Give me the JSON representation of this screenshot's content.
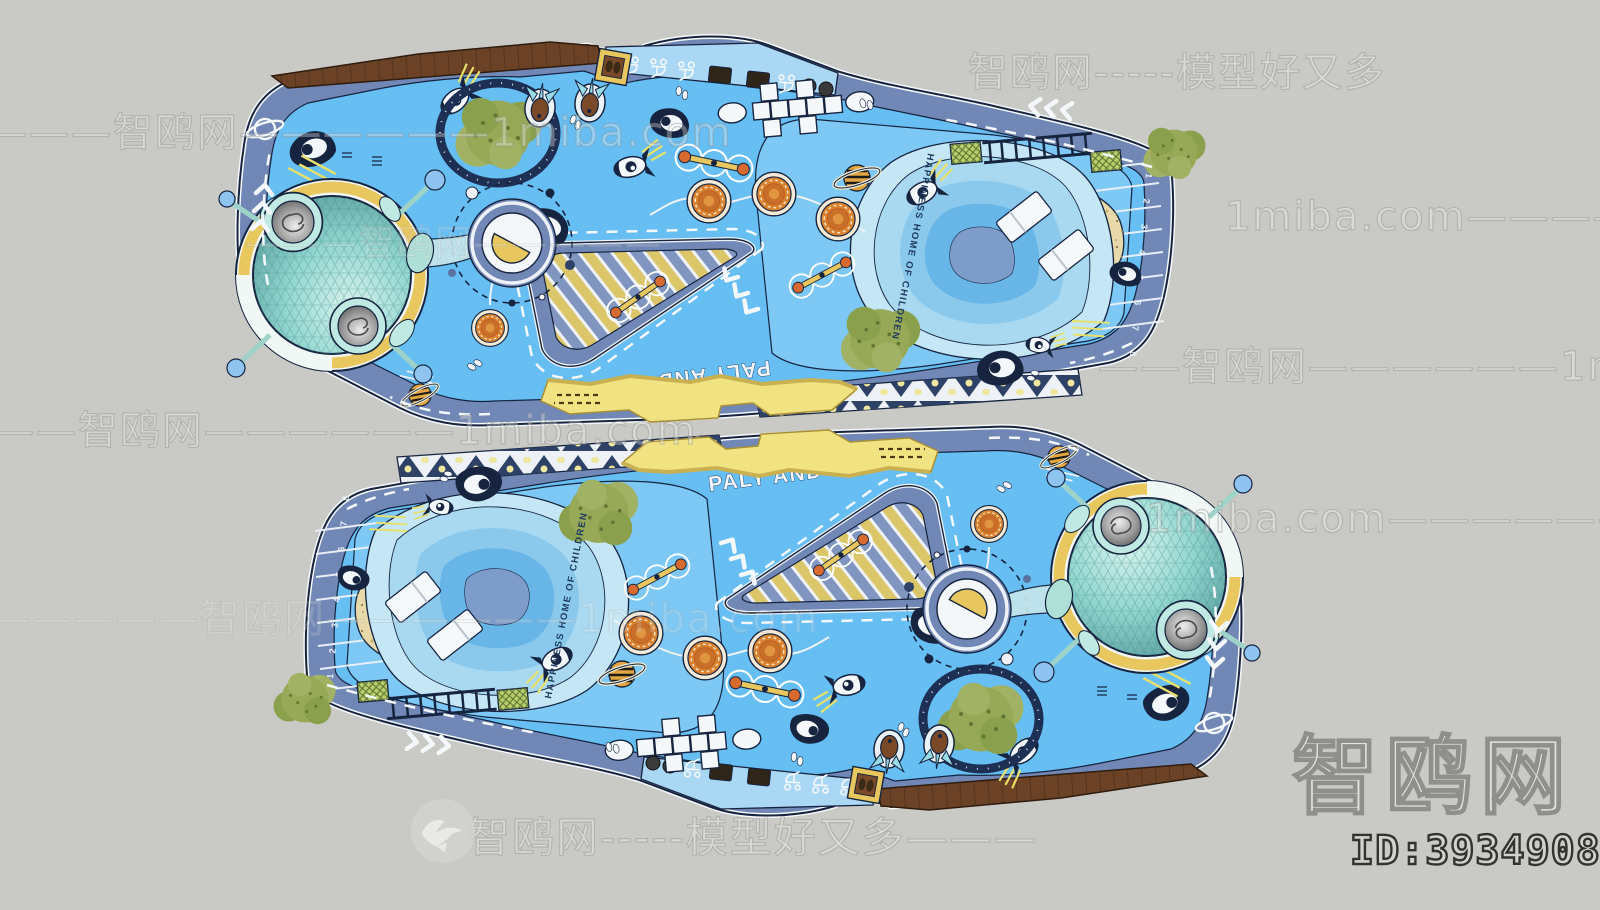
{
  "image": {
    "type": "3d-model-top-view-preview",
    "subject": "space themed children playground (two copies, one rotated 180°)",
    "background": "#c9c9c5"
  },
  "model": {
    "sign_text": "PALY AND STUDY",
    "slogan_text": "HAPPINESS HOME OF CHILDREN",
    "parking_numbers": "1 2 3 4 5 6 7 8",
    "colors": {
      "ground": "#66bef3",
      "pool_zone": "#7dc8f4",
      "path_band": "#7187b5",
      "outline": "#16243f",
      "pool": [
        "#c4e6f5",
        "#a9d9f1",
        "#8bc9ec",
        "#68b5e7",
        "#7e9cc9"
      ],
      "sand": "#e8d9ab",
      "sphere_shell": "#93d6d0",
      "sphere_base": "#f0f7f5",
      "accent_yellow": "#e7c75e",
      "canopy": "#f1e382",
      "wood": "#6b4226",
      "tree": "#97a957",
      "trampoline_orange": "#d9812f"
    }
  },
  "watermarks": {
    "top_right": "智鸥网-----模型好又多",
    "left_upper": "————智鸥网——————1miba.com",
    "right_upper": "1miba.com——————智鸥网—",
    "over_sphere": "———智鸥网—————",
    "right_mid": "——智鸥网——————1miba.com",
    "left_mid": "———智鸥网——————1miba.com",
    "right_lower": "1miba.com——————智鸥网——————",
    "left_lower": "—————智鸥网——————1miba.com",
    "bottom": "智鸥网-----模型好又多———",
    "bird_icon": "seagull",
    "logo_text": "智鸥网",
    "id_text": "ID:393490842"
  }
}
